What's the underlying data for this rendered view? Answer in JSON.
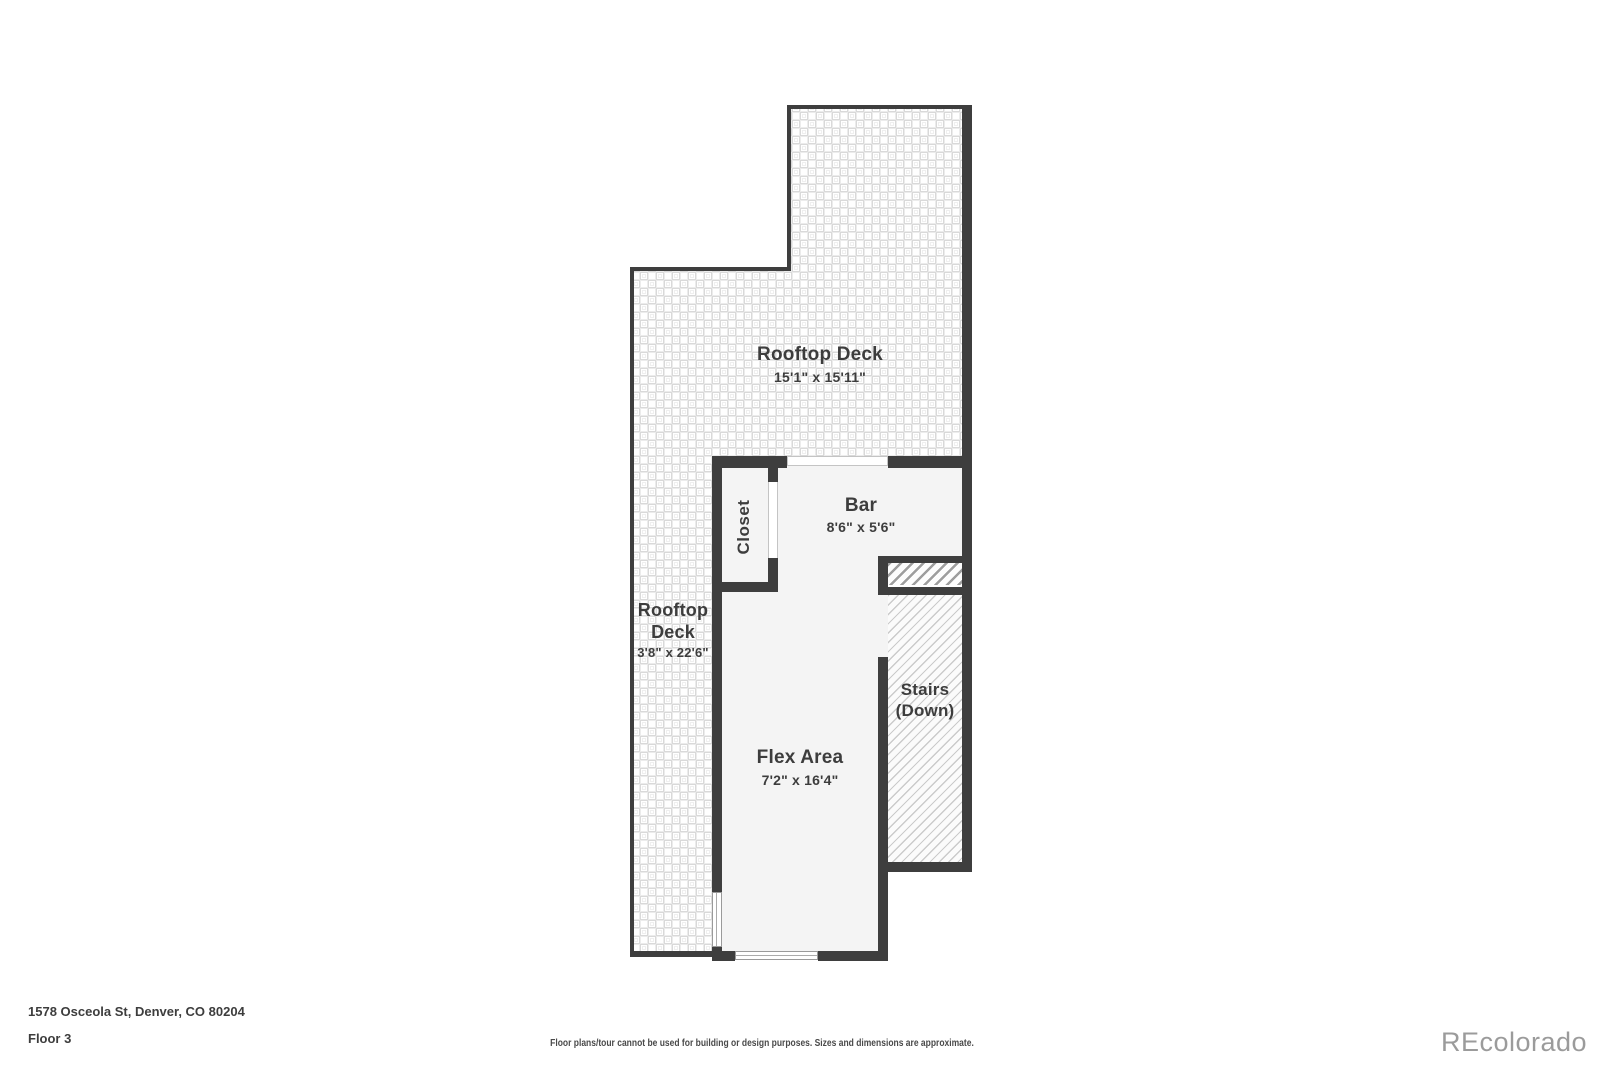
{
  "palette": {
    "wall": "#3e3e3e",
    "room": "#f4f4f4",
    "text": "#3d3d3d",
    "logo": "#9b9b9b",
    "window-frame": "#9a9a9a",
    "door-frame": "#c4c4c4"
  },
  "plan": {
    "rooms": {
      "rooftop_deck_top": {
        "name": "Rooftop Deck",
        "dims": "15'1\" x 15'11\""
      },
      "rooftop_deck_left": {
        "line1": "Rooftop",
        "line2": "Deck",
        "dims": "3'8\" x 22'6\""
      },
      "bar": {
        "name": "Bar",
        "dims": "8'6\" x 5'6\""
      },
      "closet": {
        "name": "Closet"
      },
      "stairs": {
        "line1": "Stairs",
        "line2": "(Down)"
      },
      "flex_area": {
        "name": "Flex Area",
        "dims": "7'2\" x 16'4\""
      }
    }
  },
  "footer": {
    "address": "1578 Osceola St, Denver, CO 80204",
    "floor_label": "Floor 3",
    "disclaimer": "Floor plans/tour cannot be used for building or design purposes. Sizes and dimensions are approximate.",
    "watermark": "REcolorado"
  }
}
